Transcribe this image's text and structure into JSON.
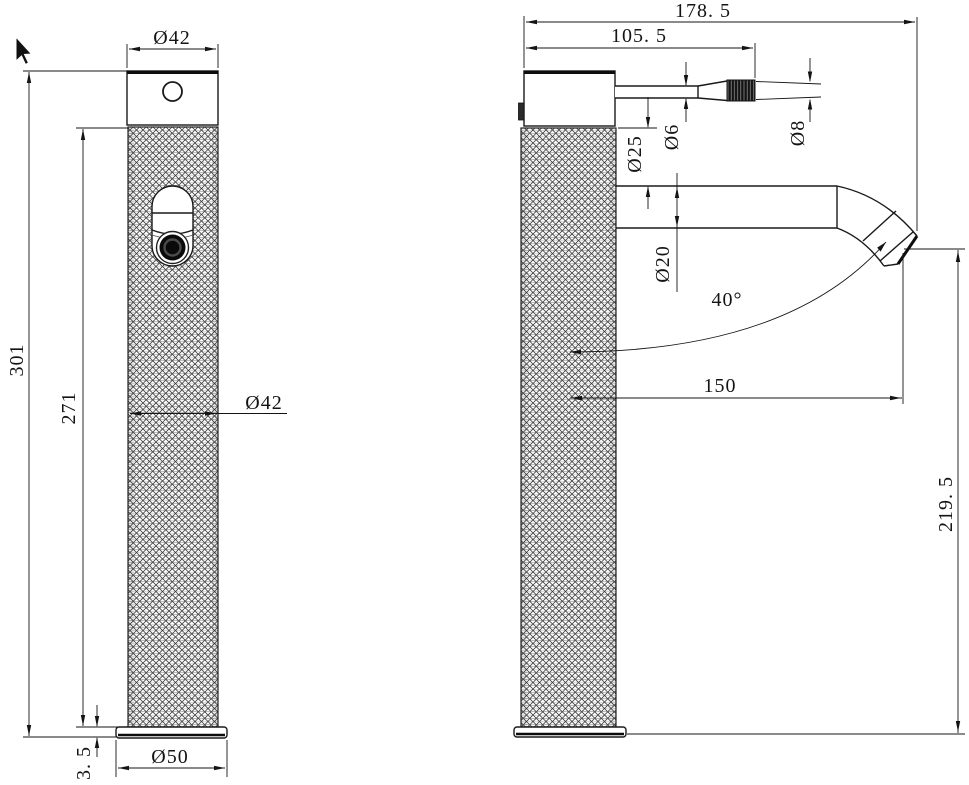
{
  "drawing": {
    "front_view": {
      "top_diameter": "Ø42",
      "overall_height": "301",
      "body_height": "271",
      "body_diameter": "Ø42",
      "base_thickness": "3. 5",
      "base_diameter": "Ø50"
    },
    "side_view": {
      "overall_depth": "178. 5",
      "handle_length": "105. 5",
      "handle_stem_diameter": "Ø6",
      "handle_grip_diameter": "Ø8",
      "neck_diameter": "Ø25",
      "spout_diameter": "Ø20",
      "spout_angle": "40°",
      "spout_reach": "150",
      "outlet_height": "219. 5"
    }
  }
}
